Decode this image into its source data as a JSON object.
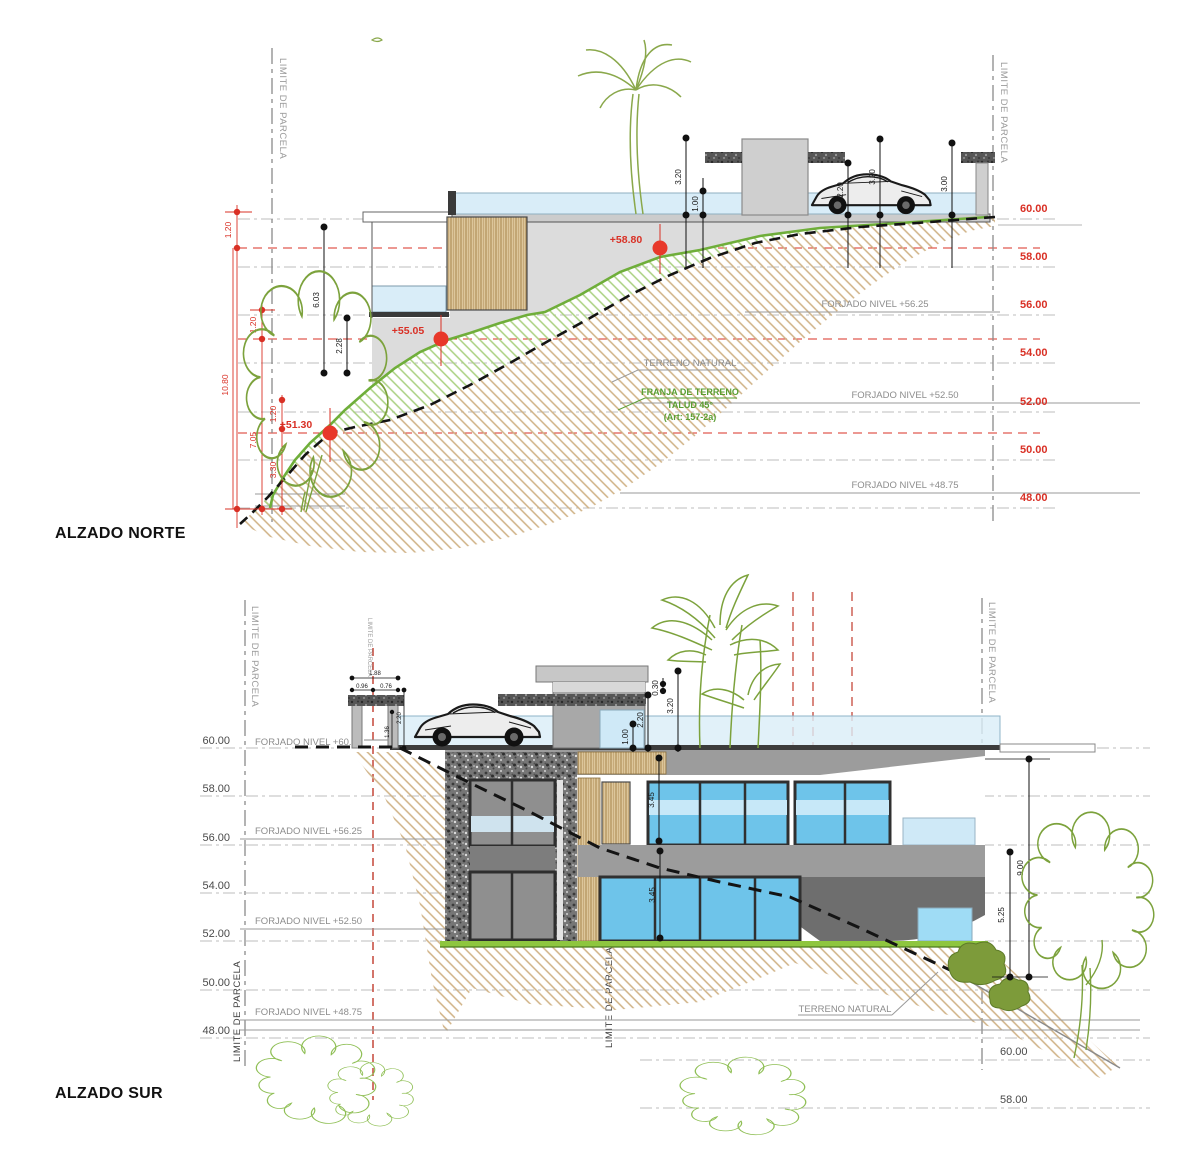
{
  "titles": {
    "north": "ALZADO NORTE",
    "south": "ALZADO SUR"
  },
  "labels": {
    "limite": "LIMITE DE PARCELA",
    "terreno_natural": "TERRENO NATURAL",
    "franja": "FRANJA DE TERRENO",
    "talud": "TALUD 45°",
    "articulo": "(Art: 157-2a)"
  },
  "forjado": {
    "n60": "FORJADO NIVEL +60.00",
    "n5625": "FORJADO NIVEL +56.25",
    "n5250": "FORJADO NIVEL +52.50",
    "n4875": "FORJADO NIVEL +48.75"
  },
  "north": {
    "levels": [
      "60.00",
      "58.00",
      "56.00",
      "54.00",
      "52.00",
      "50.00",
      "48.00"
    ],
    "markers": {
      "m1": "+58.80",
      "m2": "+55.05",
      "m3": "+51.30"
    },
    "dims": {
      "d320a": "3.20",
      "d100": "1.00",
      "d220": "2.20",
      "d320b": "3.20",
      "d300": "3.00",
      "d603": "6.03",
      "d228": "2.28",
      "d120a": "1.20",
      "d1080": "10.80",
      "d120b": "1.20",
      "d705": "7.05",
      "d120c": "1.20",
      "d330": "3.30"
    }
  },
  "south": {
    "levels": [
      "60.00",
      "58.00",
      "56.00",
      "54.00",
      "52.00",
      "50.00",
      "48.00"
    ],
    "right_levels": [
      "60.00",
      "58.00"
    ],
    "dims": {
      "d030": "0.30",
      "d320": "3.20",
      "d220": "2.20",
      "d100": "1.00",
      "d345a": "3.45",
      "d345b": "3.45",
      "d900": "9.00",
      "d525": "5.25",
      "g188": "1.88",
      "g096": "0.96",
      "g076": "0.76",
      "g220": "2.20",
      "g136": "1.36"
    }
  }
}
